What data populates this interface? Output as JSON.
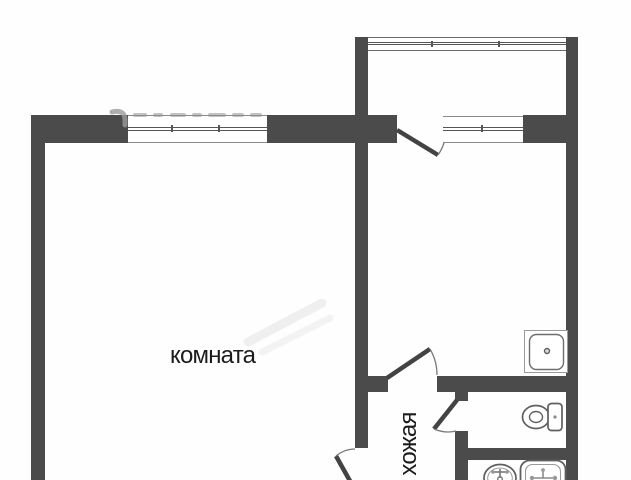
{
  "floorplan": {
    "labels": {
      "room": "комната",
      "hallway": "хожая"
    },
    "colors": {
      "wall": "#4b4b4b",
      "door_leaf": "#434343",
      "door_arc": "#7a7a7a",
      "window_frame": "#8a8a8a",
      "window_glass": "#565656",
      "fixture_stroke": "#5f5f5f",
      "text": "#1c1c1c",
      "background": "#fefefe",
      "watermark": "#9b9b9b"
    },
    "icons": {
      "kitchen_sink": "kitchen-sink-icon",
      "toilet": "toilet-icon",
      "washbasin": "washbasin-icon",
      "bath": "bathtub-icon"
    }
  }
}
